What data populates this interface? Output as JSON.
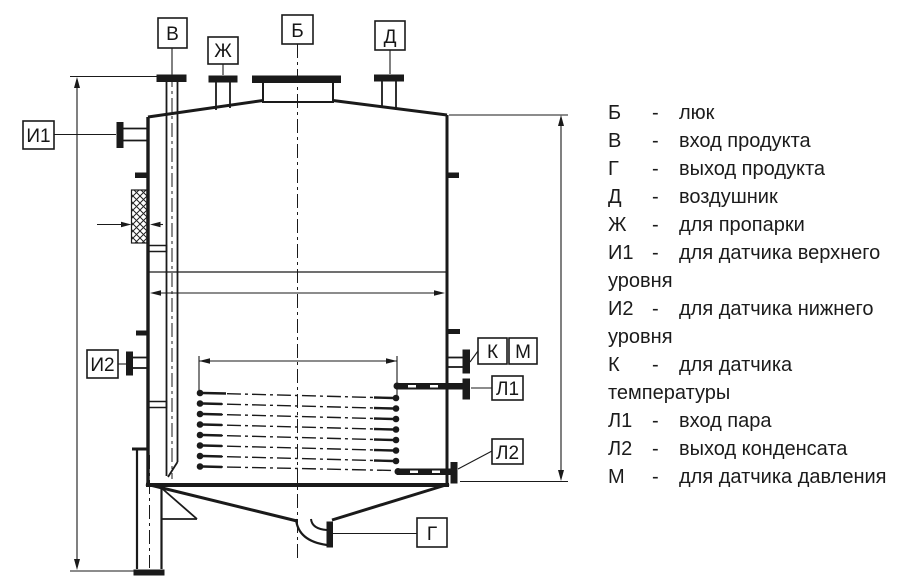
{
  "legend": {
    "lines": [
      {
        "code": "Б",
        "sep": "-",
        "text": "люк"
      },
      {
        "code": "В",
        "sep": "-",
        "text": "вход продукта"
      },
      {
        "code": "Г",
        "sep": "-",
        "text": "выход продукта"
      },
      {
        "code": "Д",
        "sep": "-",
        "text": "воздушник"
      },
      {
        "code": "Ж",
        "sep": "-",
        "text": "для пропарки"
      },
      {
        "code": "И1",
        "sep": "-",
        "text": "для датчика верхнего"
      },
      {
        "cont": "уровня"
      },
      {
        "code": "И2",
        "sep": "-",
        "text": "для датчика нижнего"
      },
      {
        "cont": "уровня"
      },
      {
        "code": "К",
        "sep": "-",
        "text": "для датчика"
      },
      {
        "cont": "температуры"
      },
      {
        "code": "Л1",
        "sep": "-",
        "text": "вход пара"
      },
      {
        "code": "Л2",
        "sep": "-",
        "text": "выход конденсата"
      },
      {
        "code": "М",
        "sep": "-",
        "text": "для датчика давления"
      }
    ]
  },
  "drawing": {
    "callouts": {
      "v": "В",
      "zh": "Ж",
      "b": "Б",
      "d": "Д",
      "i1": "И1",
      "i2": "И2",
      "k": "К",
      "m": "М",
      "l1": "Л1",
      "l2": "Л2",
      "g": "Г"
    },
    "line_color": "#1a1a1a",
    "background": "#ffffff"
  }
}
